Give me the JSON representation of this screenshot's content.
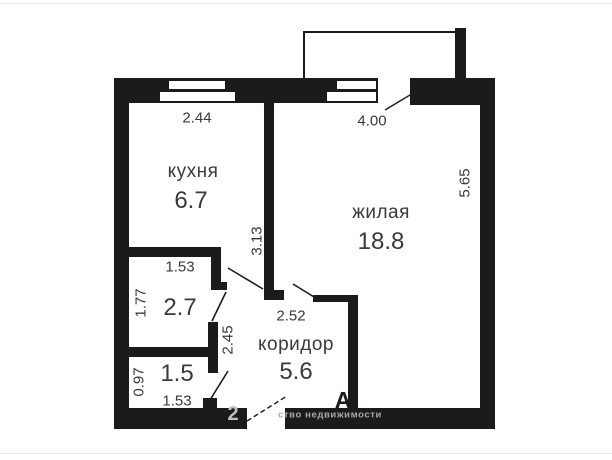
{
  "plan": {
    "title": "apartment-floor-plan",
    "rooms": {
      "kitchen": {
        "label": "кухня",
        "area": "6.7"
      },
      "living": {
        "label": "жилая",
        "area": "18.8"
      },
      "corridor": {
        "label": "коридор",
        "area": "5.6"
      },
      "bathroom": {
        "area": "2.7"
      },
      "wc": {
        "area": "1.5"
      }
    },
    "dimensions": {
      "kitchen_width": "2.44",
      "living_width": "4.00",
      "living_height": "5.65",
      "divider_height": "3.13",
      "bathroom_width": "1.53",
      "bathroom_height": "1.77",
      "corridor_height": "2.45",
      "corridor_width": "2.52",
      "wc_height": "0.97",
      "wc_width": "1.53"
    },
    "watermark": {
      "big_letter": "А",
      "logo_glyph": "2",
      "text": "ство недвижимости"
    },
    "colors": {
      "wall": "#1d1a1e",
      "text": "#3a3a3a",
      "watermark": "#a8a8a8",
      "frame": "#e6e6e6"
    }
  }
}
